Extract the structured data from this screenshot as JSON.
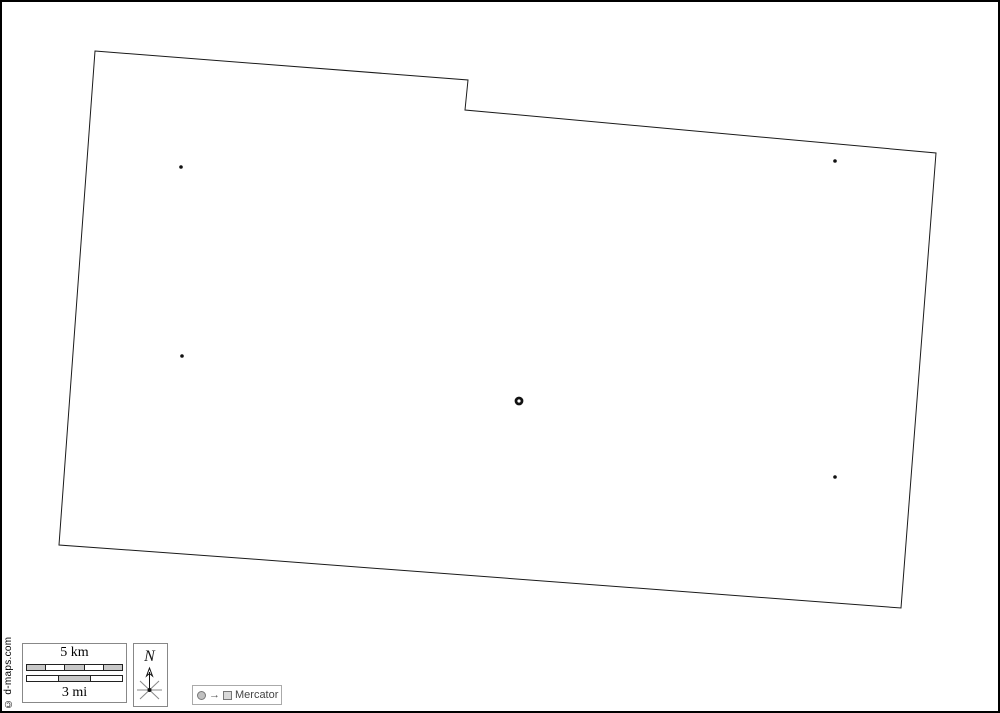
{
  "frame": {
    "background": "#ffffff",
    "border_color": "#000000"
  },
  "map": {
    "outline": {
      "points": [
        [
          93,
          49
        ],
        [
          466,
          78
        ],
        [
          463,
          108
        ],
        [
          934,
          151
        ],
        [
          899,
          606
        ],
        [
          250,
          557
        ],
        [
          57,
          543
        ]
      ],
      "stroke_color": "#1a1a1a",
      "fill_color": "#ffffff"
    },
    "markers": {
      "dots": [
        [
          179,
          165
        ],
        [
          180,
          354
        ],
        [
          833,
          159
        ],
        [
          833,
          475
        ]
      ],
      "dot_color": "#111111",
      "ring": {
        "x": 517,
        "y": 399,
        "color": "#111111"
      }
    }
  },
  "attribution": {
    "text": "© d-maps.com"
  },
  "scale_bar": {
    "km_label": "5 km",
    "mi_label": "3 mi",
    "km_segments": [
      "#c8c8c8",
      "#ffffff",
      "#c8c8c8",
      "#ffffff",
      "#c8c8c8"
    ],
    "mi_segments": [
      "#ffffff",
      "#c8c8c8",
      "#ffffff"
    ]
  },
  "compass": {
    "label": "N",
    "star_color": "#888888",
    "arrow_color": "#111111"
  },
  "legend": {
    "arrow": "→",
    "label": "Mercator",
    "circle_color": "#c0c0c0",
    "square_color": "#d9d9d9"
  }
}
